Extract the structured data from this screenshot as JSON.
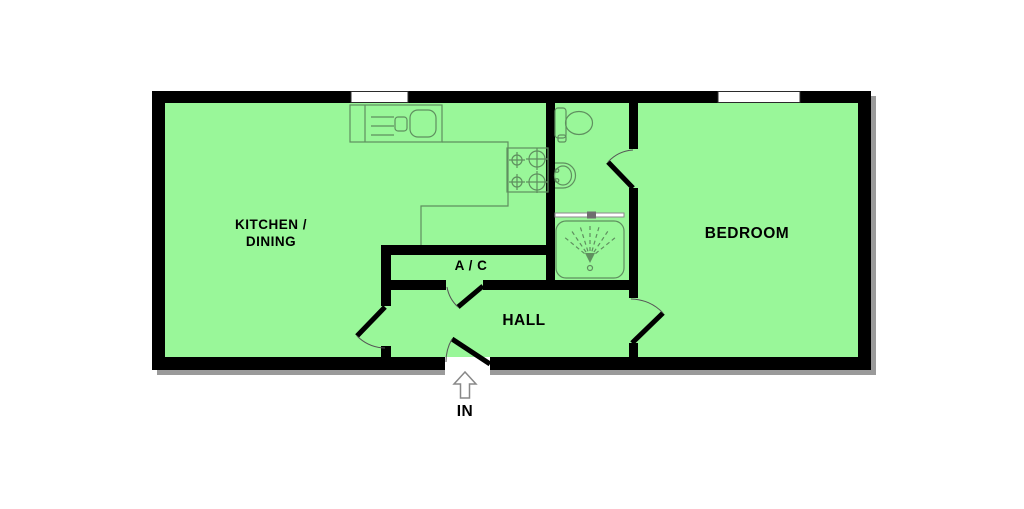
{
  "colors": {
    "page_bg": "#ffffff",
    "floor": "#99f799",
    "wall": "#000000",
    "fixture_line": "#5f8f5f",
    "door_arc": "#555555",
    "window_fill": "#ffffff",
    "window_border": "#2b2b2b",
    "shadow": "#9a9a9a",
    "label_text": "#000000",
    "entrance_arrow": "#888888"
  },
  "rooms": [
    {
      "id": "kitchen-dining",
      "label_line1": "KITCHEN /",
      "label_line2": "DINING"
    },
    {
      "id": "ac-closet",
      "label": "A / C"
    },
    {
      "id": "hall",
      "label": "HALL"
    },
    {
      "id": "bedroom",
      "label": "BEDROOM"
    }
  ],
  "entrance": {
    "label": "IN",
    "icon": "up-arrow-outline-icon"
  },
  "fixtures": [
    "kitchen-sink-drainer",
    "kitchen-worktop",
    "hob-4-burners",
    "toilet",
    "basin",
    "shower-enclosure"
  ],
  "windows": [
    {
      "id": "kitchen-window"
    },
    {
      "id": "bedroom-window"
    }
  ],
  "doors": [
    "entrance-door",
    "kitchen-hall-door",
    "ac-closet-door",
    "hall-bedroom-door",
    "bathroom-door"
  ]
}
